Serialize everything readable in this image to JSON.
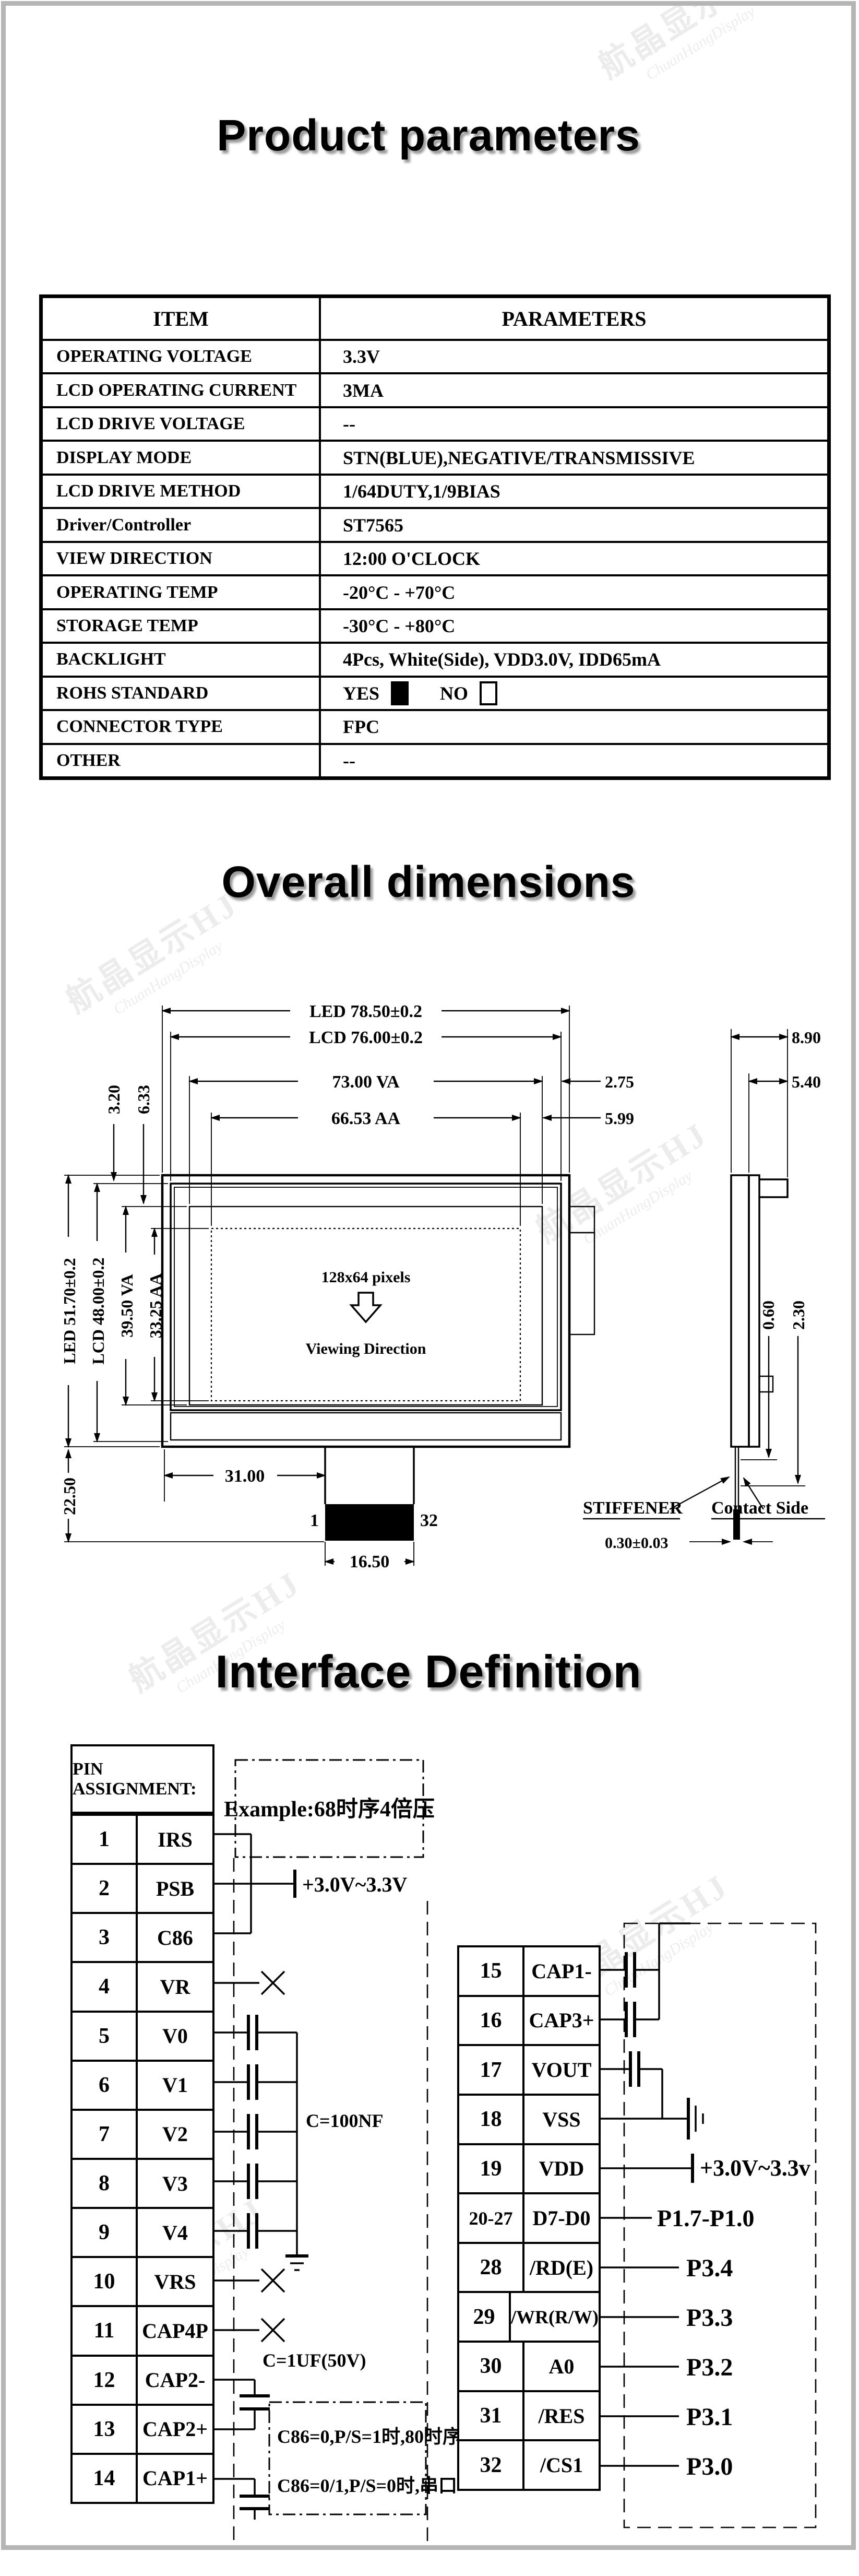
{
  "watermark": {
    "line1": "航晶显示HJ",
    "line2": "ChuanHangDisplay"
  },
  "parameters": {
    "title": "Product parameters",
    "headers": {
      "item": "ITEM",
      "value": "PARAMETERS"
    },
    "rows": [
      {
        "item": "OPERATING VOLTAGE",
        "value": "3.3V"
      },
      {
        "item": "LCD OPERATING CURRENT",
        "value": "3MA"
      },
      {
        "item": "LCD DRIVE VOLTAGE",
        "value": "--"
      },
      {
        "item": "DISPLAY MODE",
        "value": "STN(BLUE),NEGATIVE/TRANSMISSIVE"
      },
      {
        "item": "LCD DRIVE METHOD",
        "value": "1/64DUTY,1/9BIAS"
      },
      {
        "item": "Driver/Controller",
        "value": "ST7565"
      },
      {
        "item": "VIEW DIRECTION",
        "value": "12:00 O'CLOCK"
      },
      {
        "item": "OPERATING TEMP",
        "value": "-20°C - +70°C"
      },
      {
        "item": "STORAGE TEMP",
        "value": "-30°C - +80°C"
      },
      {
        "item": "BACKLIGHT",
        "value": "4Pcs, White(Side), VDD3.0V, IDD65mA"
      },
      {
        "item": "ROHS STANDARD",
        "yes": "YES",
        "no": "NO"
      },
      {
        "item": "CONNECTOR TYPE",
        "value": "FPC"
      },
      {
        "item": "OTHER",
        "value": "--"
      }
    ]
  },
  "dimensions": {
    "title": "Overall dimensions",
    "top_dims": [
      "LED 78.50±0.2",
      "LCD 76.00±0.2",
      "73.00 VA",
      "66.53 AA"
    ],
    "right_dims": [
      "2.75",
      "5.99"
    ],
    "side_top_dims": [
      "8.90",
      "5.40"
    ],
    "left_dims": [
      "LED 51.70±0.2",
      "LCD 48.00±0.2",
      "39.50 VA",
      "33.25 AA"
    ],
    "corner_dims": [
      "3.20",
      "6.33"
    ],
    "bottom_left_dim": "22.50",
    "bottom_dims": [
      "31.00",
      "16.50"
    ],
    "side_right_dims": [
      "0.60",
      "2.30"
    ],
    "fpc_thickness": "0.30±0.03",
    "pins": {
      "first": "1",
      "last": "32"
    },
    "screen": {
      "line1": "128x64 pixels",
      "line2": "Viewing Direction"
    },
    "callouts": {
      "stiffener": "STIFFENER",
      "contact_side": "Contact Side"
    }
  },
  "interface": {
    "title": "Interface Definition",
    "pin_header": "PIN ASSIGNMENT:",
    "example_note": "Example:68时序4倍压",
    "left_pins": [
      [
        "1",
        "IRS"
      ],
      [
        "2",
        "PSB"
      ],
      [
        "3",
        "C86"
      ],
      [
        "4",
        "VR"
      ],
      [
        "5",
        "V0"
      ],
      [
        "6",
        "V1"
      ],
      [
        "7",
        "V2"
      ],
      [
        "8",
        "V3"
      ],
      [
        "9",
        "V4"
      ],
      [
        "10",
        "VRS"
      ],
      [
        "11",
        "CAP4P"
      ],
      [
        "12",
        "CAP2-"
      ],
      [
        "13",
        "CAP2+"
      ],
      [
        "14",
        "CAP1+"
      ]
    ],
    "right_pins": [
      [
        "15",
        "CAP1-"
      ],
      [
        "16",
        "CAP3+"
      ],
      [
        "17",
        "VOUT"
      ],
      [
        "18",
        "VSS"
      ],
      [
        "19",
        "VDD"
      ],
      [
        "20-27",
        "D7-D0"
      ],
      [
        "28",
        "/RD(E)"
      ],
      [
        "29",
        "/WR(R/W)"
      ],
      [
        "30",
        "A0"
      ],
      [
        "31",
        "/RES"
      ],
      [
        "32",
        "/CS1"
      ]
    ],
    "supply_left": "+3.0V~3.3V",
    "cap_note1": "C=100NF",
    "cap_note2": "C=1UF(50V)",
    "mode_notes": [
      "C86=0,P/S=1时,80时序",
      "C86=0/1,P/S=0时,串口"
    ],
    "supply_right": "+3.0V~3.3v",
    "mcu_port_labels": [
      "P1.7-P1.0",
      "P3.4",
      "P3.3",
      "P3.2",
      "P3.1",
      "P3.0"
    ]
  }
}
